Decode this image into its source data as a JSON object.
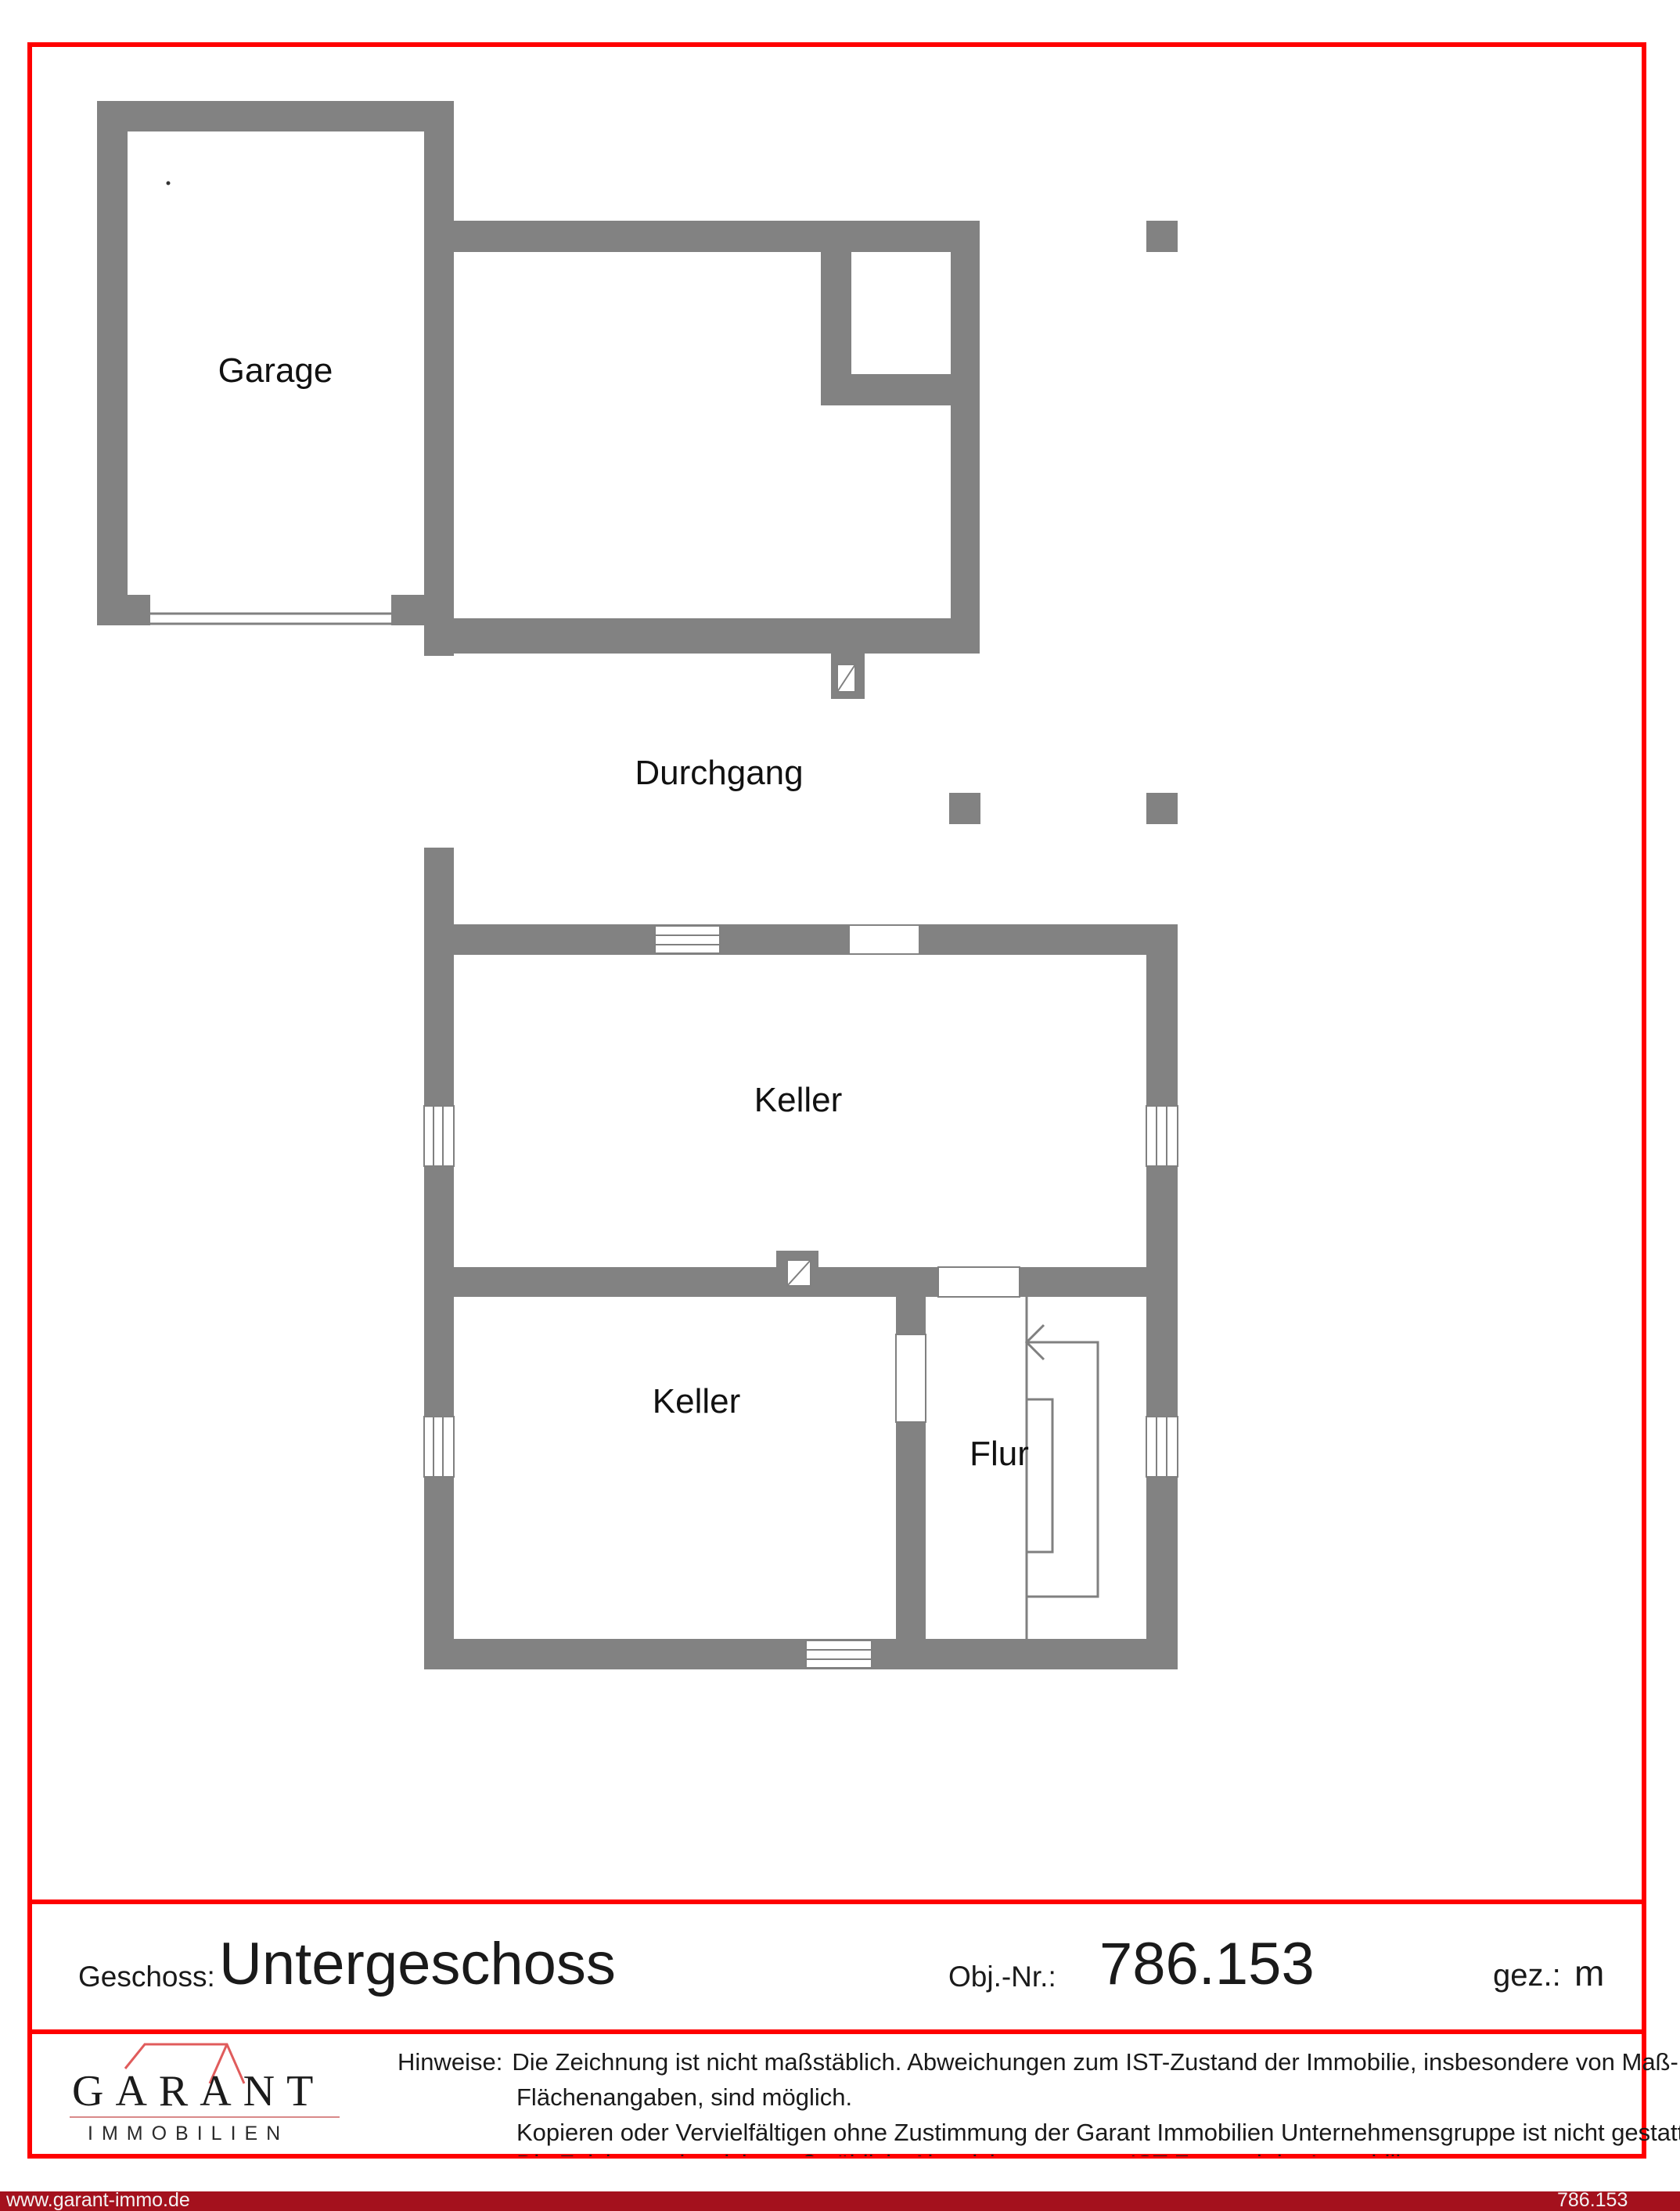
{
  "plan": {
    "rooms": {
      "garage": "Garage",
      "durchgang": "Durchgang",
      "keller_upper": "Keller",
      "keller_lower": "Keller",
      "flur": "Flur"
    }
  },
  "title_row": {
    "geschoss_label": "Geschoss:",
    "geschoss_value": "Untergeschoss",
    "obj_label": "Obj.-Nr.:",
    "obj_value": "786.153",
    "gez_label": "gez.:",
    "gez_value": "m"
  },
  "footer": {
    "logo_name": "GARANT",
    "logo_subtitle": "IMMOBILIEN",
    "hinweise_label": "Hinweise:",
    "hinweise_line1": "Die Zeichnung ist nicht maßstäblich. Abweichungen zum IST-Zustand der Immobilie, insbesondere von Maß- und",
    "hinweise_line2": "Flächenangaben, sind möglich.",
    "hinweise_line3": "Kopieren oder Vervielfältigen ohne Zustimmung der Garant Immobilien Unternehmensgruppe ist nicht gestattet!",
    "hinweise_clipped_line": "Die Zeichnung ist nicht maßstäblich. Abweichungen zum IST-Zustand der Immobilie"
  },
  "bottom_bar": {
    "left": "www.garant-immo.de",
    "right": "786.153"
  },
  "colors": {
    "wall_gray": "#828282",
    "thin_line_gray": "#808080",
    "frame_red": "#ff0000",
    "bar_red": "#a4111d",
    "logo_roof_red": "#e05c5c",
    "text_black": "#111111"
  }
}
